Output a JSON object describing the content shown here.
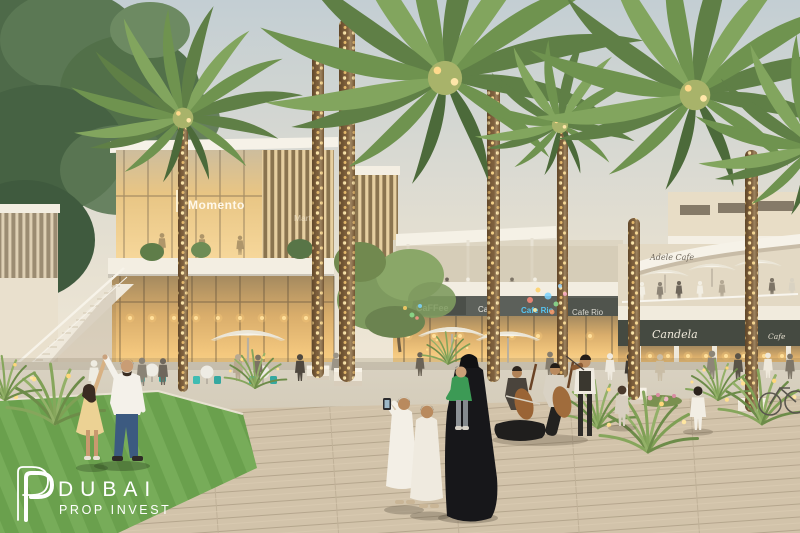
{
  "scene": {
    "description": "Dusk architectural rendering of a landscaped retail plaza: palm trees wrapped in golden string lights, two-storey cafe pavilions with glowing glass storefronts, rooftop terraces, street musicians and strolling families on a timber boardwalk"
  },
  "watermark": {
    "brand": "DUBAI",
    "tagline": "PROP INVEST"
  },
  "signs": {
    "momento": "Momento",
    "marten": "Marten",
    "caffee": "CaFFee",
    "cafe": "Cafe",
    "cafe_rio_blue": "Cafe Rio",
    "cafe_rio": "Cafe Rio",
    "terrace_script": "Adele Cafe",
    "candela": "Candela",
    "cafe_small": "Cafe"
  },
  "colors": {
    "sky_top": "#c3ced3",
    "sky_horizon": "#f5ebd8",
    "palm_green": "#5f7f46",
    "string_lights_gold": "#ffe9ad",
    "interior_glow": "#f4c87e",
    "lawn_green": "#6aa04d",
    "deck_tan": "#d2c3aa",
    "sign_band_dark": "#454a41",
    "cafe_rio_blue": "#56c3ef",
    "teal_chair": "#3fbcb2",
    "abaya_black": "#17171a",
    "watermark_white": "#ffffff"
  }
}
